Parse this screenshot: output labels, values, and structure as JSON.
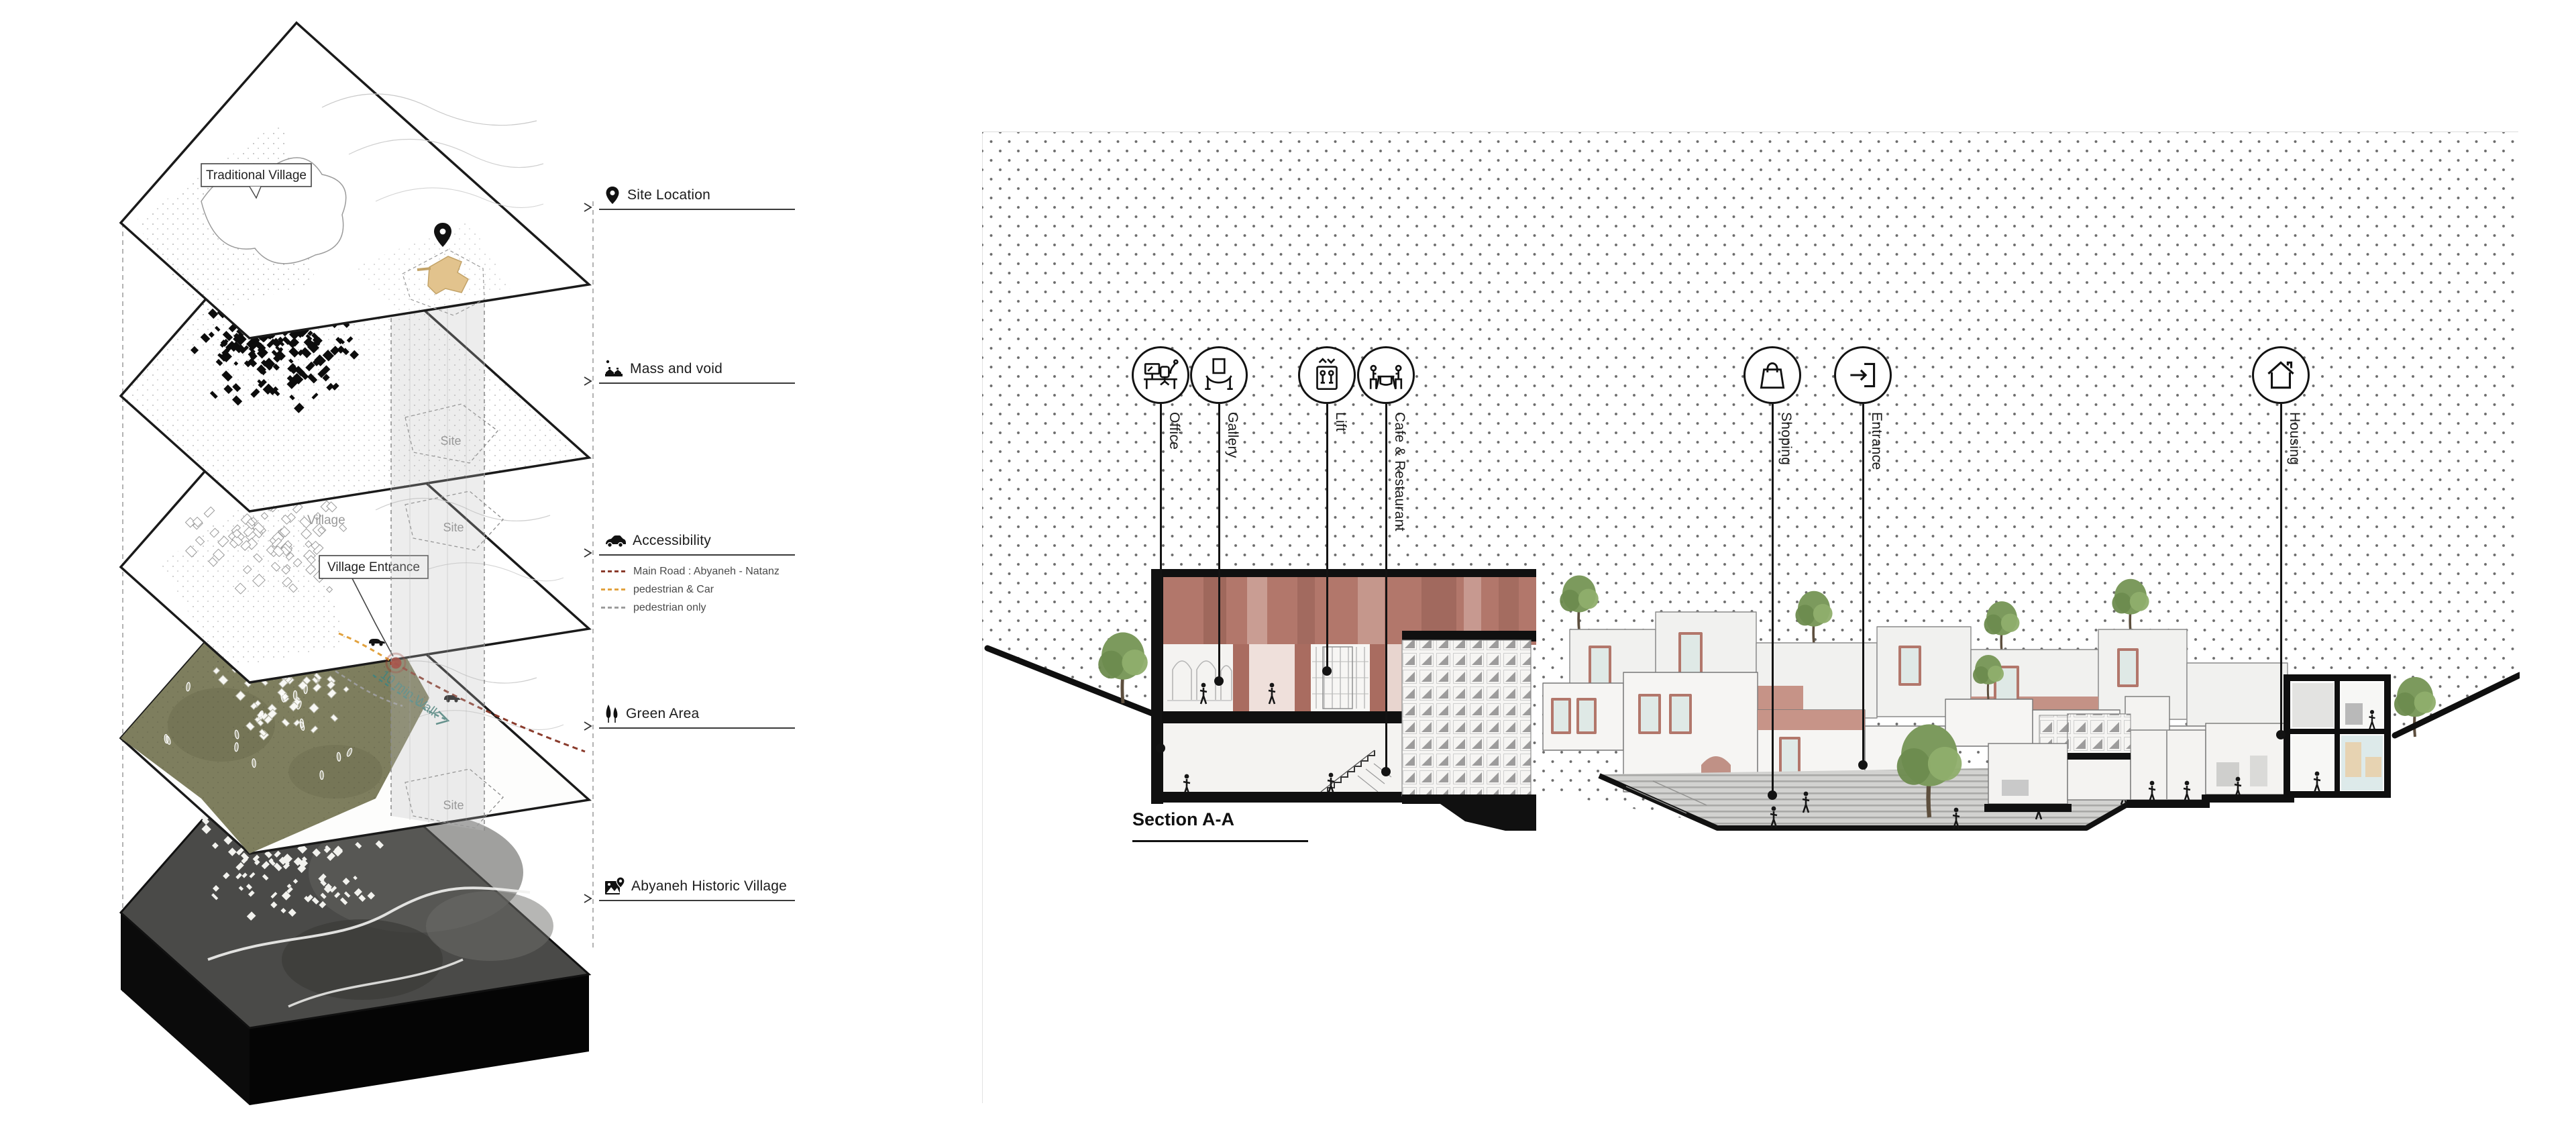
{
  "axon": {
    "map_labels": {
      "traditional_village": "Traditional Village",
      "village": "Village",
      "village_entrance": "Village Entrance",
      "site": "Site",
      "walk_time": "10 min Walk"
    },
    "layers": [
      {
        "label": "Site Location",
        "icon": "map-pin-icon"
      },
      {
        "label": "Mass and void",
        "icon": "buildings-icon"
      },
      {
        "label": "Accessibility",
        "icon": "car-icon",
        "legend": [
          {
            "label": "Main Road : Abyaneh - Natanz",
            "color": "#8a3b2c"
          },
          {
            "label": "pedestrian & Car",
            "color": "#e2a23e"
          },
          {
            "label": "pedestrian only",
            "color": "#9c9c9c"
          }
        ]
      },
      {
        "label": "Green Area",
        "icon": "trees-icon"
      },
      {
        "label": "Abyaneh Historic Village",
        "icon": "map-photo-icon"
      }
    ]
  },
  "section": {
    "title": "Section A-A",
    "callouts": [
      {
        "label": "Office",
        "icon": "office-desk-icon"
      },
      {
        "label": "Gallery",
        "icon": "gallery-icon"
      },
      {
        "label": "Lift",
        "icon": "lift-icon"
      },
      {
        "label": "Cafe & Restaurant",
        "icon": "cafe-restaurant-icon"
      },
      {
        "label": "Shoping",
        "icon": "shopping-bag-icon"
      },
      {
        "label": "Entrance",
        "icon": "entrance-door-icon"
      },
      {
        "label": "Housing",
        "icon": "house-icon"
      }
    ]
  },
  "palette": {
    "terracotta": "#b2776b",
    "terracotta_dark": "#9c6258",
    "terracotta_pale": "#ddbfb6",
    "site_tan": "#e2c38d",
    "olive_green": "#7e7e5e",
    "tree_green": "#7c9a5d",
    "teal_note": "#46837c",
    "main_road": "#8a3b2c",
    "pedestrian_car": "#e2a23e",
    "pedestrian_only": "#9c9c9c",
    "plaza_gray": "#d2d2d0",
    "background_dot": "#464646"
  }
}
